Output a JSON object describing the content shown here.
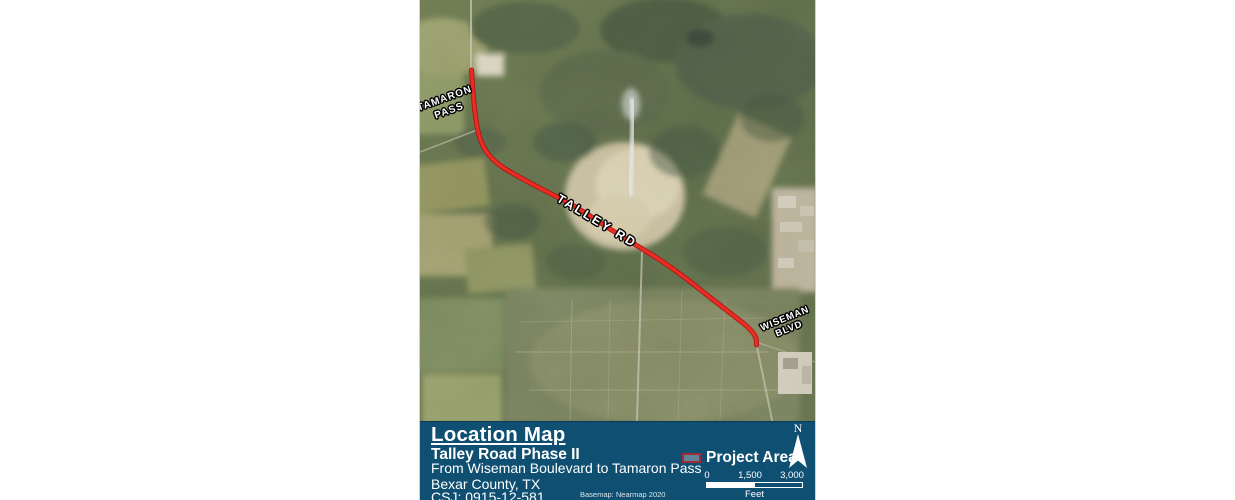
{
  "map": {
    "road_labels": {
      "tamaron_line1": "TAMARON",
      "tamaron_line2": "PASS",
      "talley": "TALLEY RD",
      "wiseman_line1": "WISEMAN",
      "wiseman_line2": "BLVD"
    }
  },
  "title_block": {
    "title": "Location Map",
    "project": "Talley Road Phase II",
    "extent": "From Wiseman Boulevard to Tamaron Pass",
    "county": "Bexar County, TX",
    "csj": "CSJ: 0915-12-581",
    "basemap_credit": "Basemap: Nearmap 2020"
  },
  "legend": {
    "project_area_label": "Project Area"
  },
  "north_arrow": {
    "label": "N"
  },
  "scale_bar": {
    "ticks": [
      "0",
      "1,500",
      "3,000"
    ],
    "unit": "Feet"
  },
  "colors": {
    "panel_blue": "#0f4f72",
    "route_red": "#ee2d22",
    "route_casing_red": "#b01217",
    "legend_swatch_border": "#a22c35",
    "terrain_base_green": "#65734e"
  }
}
